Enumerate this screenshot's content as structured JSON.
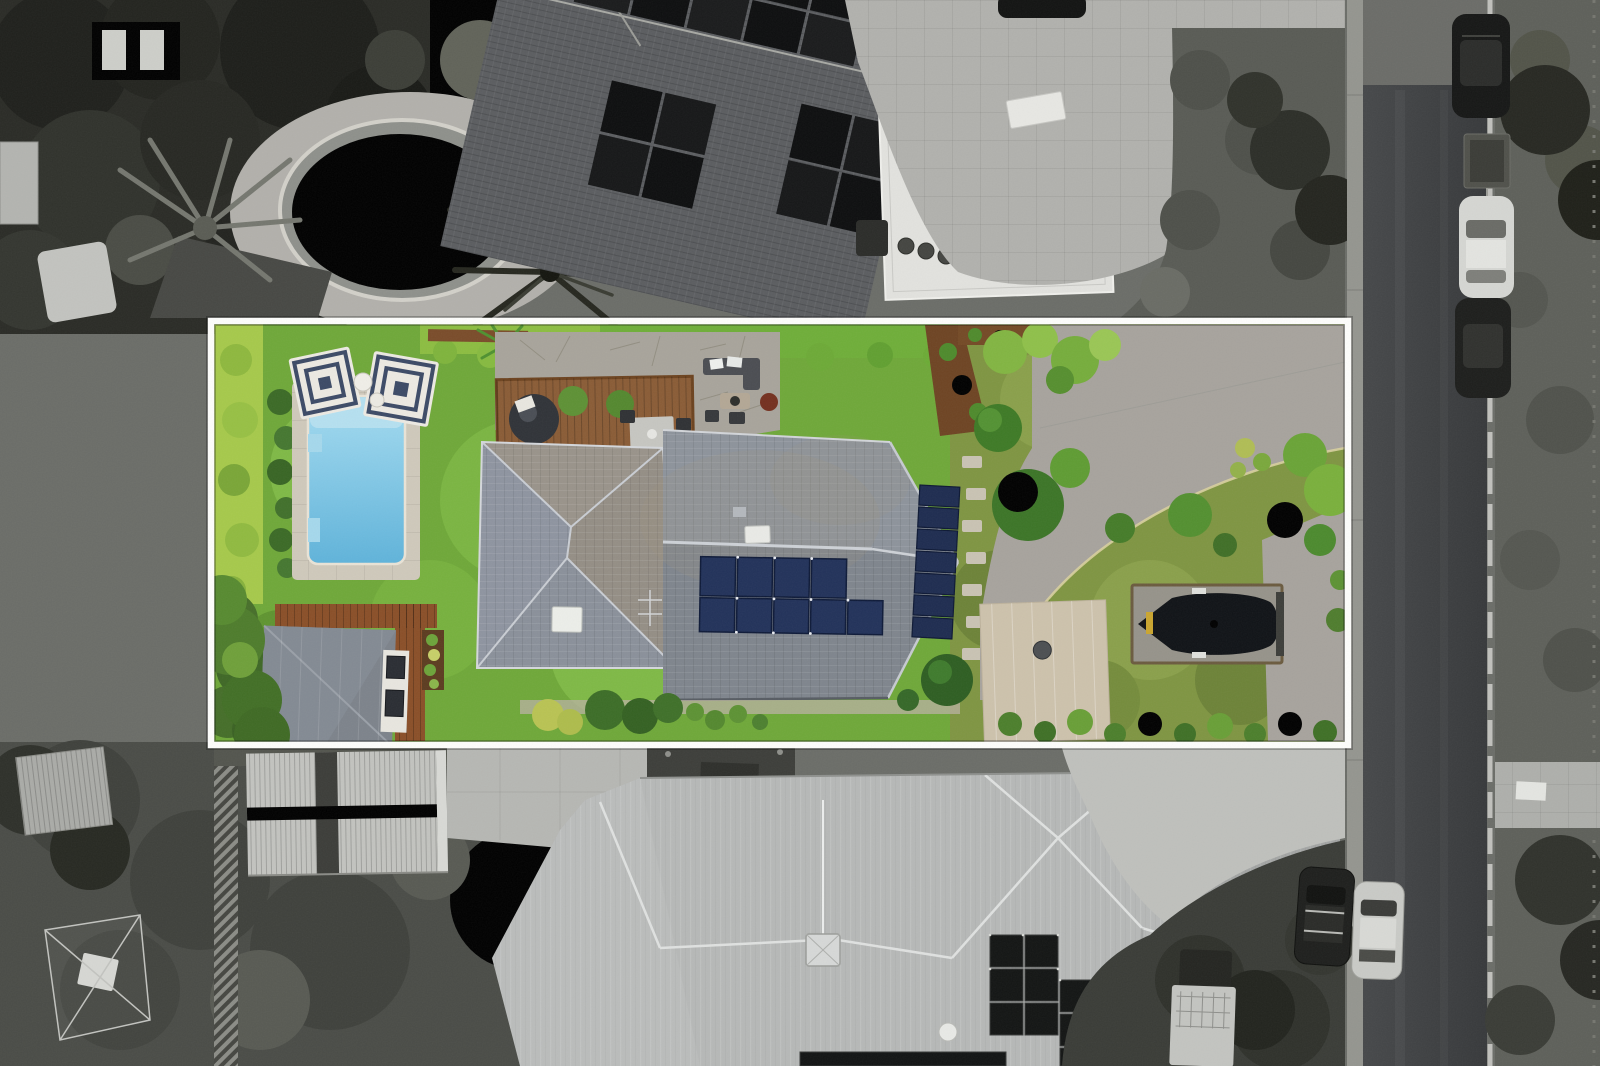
{
  "scene": {
    "title": "Aerial drone photograph of a suburban property, highlighted in colour inside a white boundary outline while the surrounding neighbourhood is greyscale",
    "type": "real-estate-aerial-photo",
    "boundary": {
      "x": 211,
      "y": 321,
      "width": 1137,
      "height": 424,
      "stroke": "white"
    }
  },
  "palette": {
    "lawn_green": "#6fa839",
    "lawn_olive": "#7f9542",
    "hedge_bright": "#a6c94b",
    "pool_blue": "#7ec9e8",
    "pool_coping": "#cfc9bb",
    "umbrella_navy": "#3c4a66",
    "umbrella_white": "#ece9e2",
    "deck_timber": "#8a5c36",
    "roof_grey": "#878d95",
    "solar_panel_blue": "#22325a",
    "solar_panel_black": "#131514",
    "driveway_grey": "#a7a39d",
    "garage_beige": "#cdc2ac",
    "boat_cover_black": "#101317",
    "street_asphalt": "#3d3f41",
    "bw_roof_light": "#b6b8b7",
    "bw_roof_dark": "#5b5d60",
    "bw_pool_paving": "#b2b0ab",
    "border_white": "#fdfdfb"
  },
  "objects": {
    "inside_boundary": [
      "lawn",
      "left-hedge",
      "swimming-pool",
      "pool-paving",
      "striped-umbrellas",
      "side-tables",
      "timber-deck",
      "egg-chair",
      "outdoor-dining-set",
      "stone-patio",
      "lounge-set",
      "fire-pit",
      "main-house-roof",
      "roof-solar-array-south",
      "roof-solar-array-east",
      "skylights",
      "garden-beds",
      "hedge-ball",
      "curved-driveway",
      "boat-on-pad",
      "garage-roof",
      "garden-shed",
      "shed-deck",
      "trees-and-shrubs"
    ],
    "outside_boundary": [
      "neighbour-oval-pool",
      "palm-trees",
      "neighbour-tiled-roof-with-solar",
      "white-flat-roof-terrace",
      "concrete-front-yard",
      "street",
      "footpath",
      "kerb",
      "parked-cars",
      "box-trailer",
      "white-van",
      "rear-lawn",
      "metal-shed",
      "strapped-shed",
      "large-metal-roof",
      "roof-solar-panels",
      "driveway-apron",
      "grass-verge",
      "side-path"
    ]
  }
}
